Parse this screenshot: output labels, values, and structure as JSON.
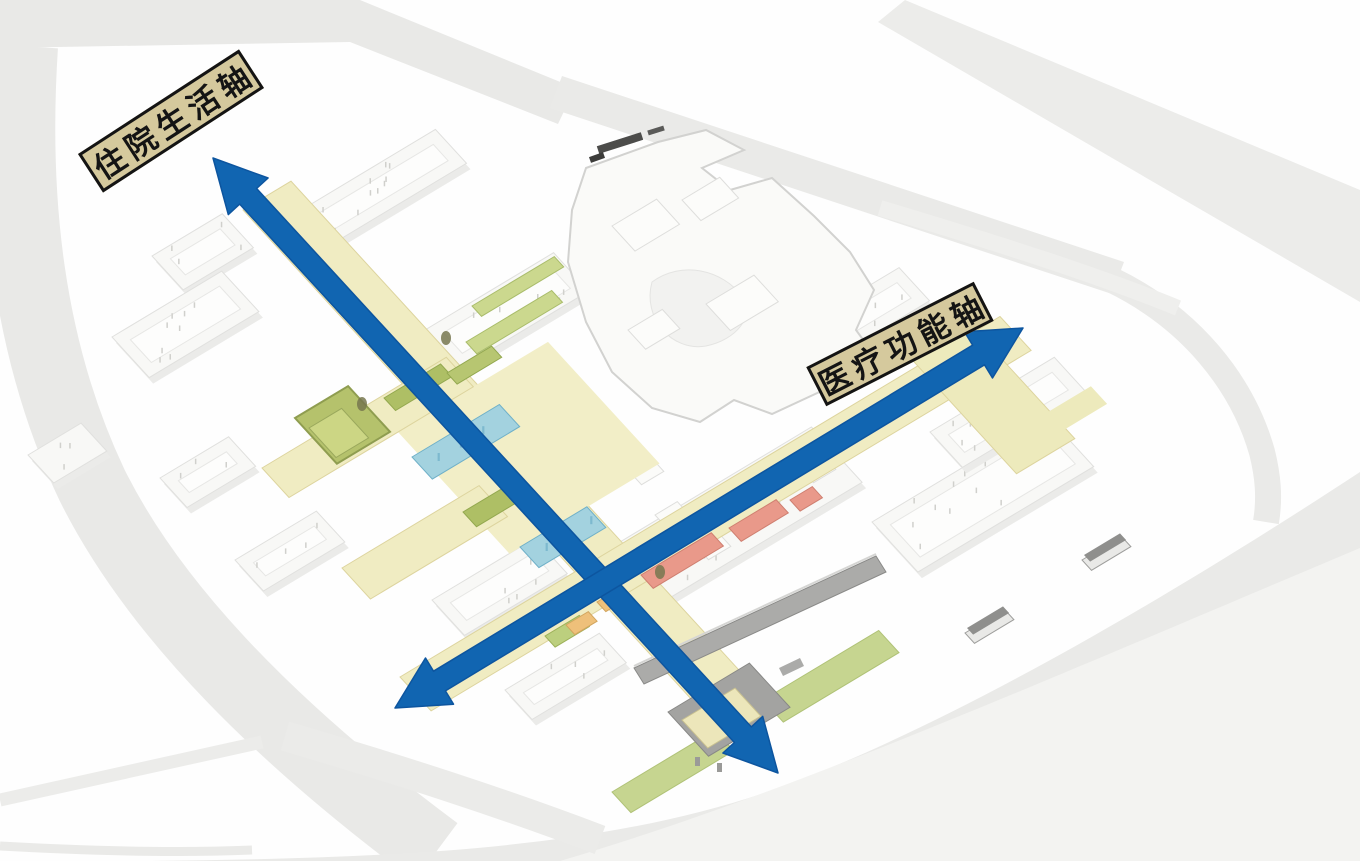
{
  "labels": {
    "inpatient_axis": "住院生活轴",
    "medical_axis": "医疗功能轴"
  },
  "arrows": [
    {
      "name": "inpatient-life-axis",
      "label": "住院生活轴",
      "style": "double-headed",
      "color": "#1165b1"
    },
    {
      "name": "medical-function-axis",
      "label": "医疗功能轴",
      "style": "double-headed",
      "color": "#1165b1"
    }
  ],
  "colors": {
    "arrow_blue": "#1165b1",
    "arrow_edge": "#0d559f",
    "label_bg": "#d5c99d",
    "label_text": "#141414",
    "band_yellow": "#f0ecc2",
    "band_edge": "#ddd49e",
    "lawn_green": "#c6d590",
    "roof_green": "#cbd88e",
    "courtyard_green": "#b5c26c",
    "building_blue": "#a3d2df",
    "building_salmon": "#e9998a",
    "building_orange": "#eec07a",
    "corridor_gray": "#ababa9",
    "road_gray": "#e9e9e7",
    "block_white": "#f8f8f6",
    "background_white": "#fefefe"
  }
}
